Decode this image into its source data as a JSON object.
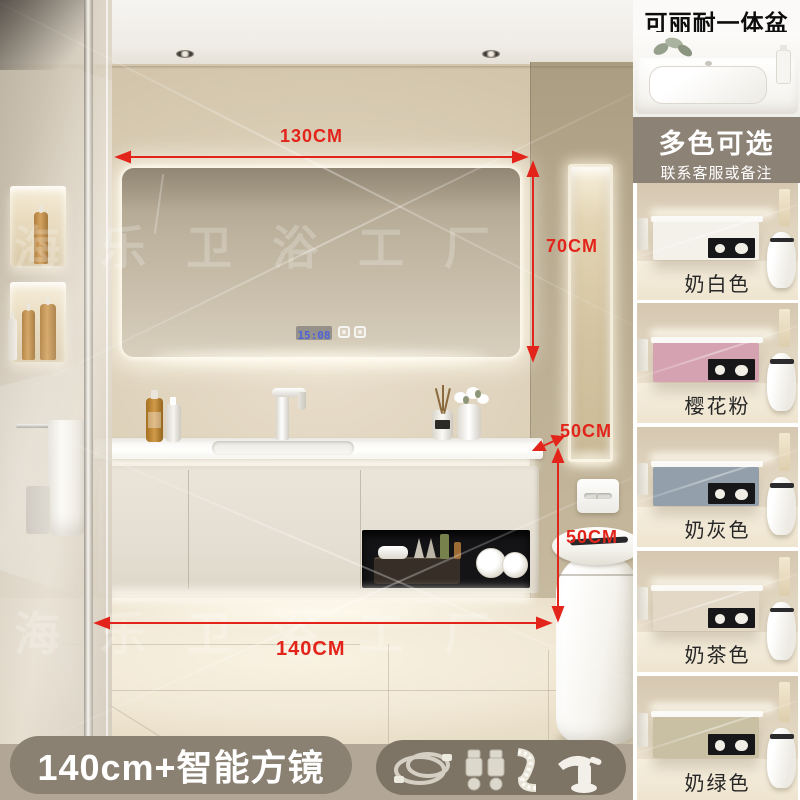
{
  "scene": {
    "watermark": "海乐卫浴工厂",
    "clock_time": "15:08",
    "dimensions": {
      "mirror_width": "130CM",
      "mirror_height": "70CM",
      "counter_depth": "50CM",
      "cabinet_height": "50CM",
      "cabinet_width": "140CM"
    },
    "annotation_color": "#e3241b"
  },
  "sidebar": {
    "header_title": "可丽耐一体盆",
    "promo_title": "多色可选",
    "promo_subtitle": "联系客服或备注",
    "color_options": [
      {
        "label": "奶白色",
        "color": "#f4f1eb"
      },
      {
        "label": "樱花粉",
        "color": "#d5a2b2"
      },
      {
        "label": "奶灰色",
        "color": "#93a0ab"
      },
      {
        "label": "奶茶色",
        "color": "#e3d8c6"
      },
      {
        "label": "奶绿色",
        "color": "#c9c0a3"
      }
    ],
    "band_bg": "#8d8276"
  },
  "footer": {
    "banner": "140cm+智能方镜",
    "banner_bg": "#8a8173",
    "accessories_bg": "#7d7466"
  }
}
